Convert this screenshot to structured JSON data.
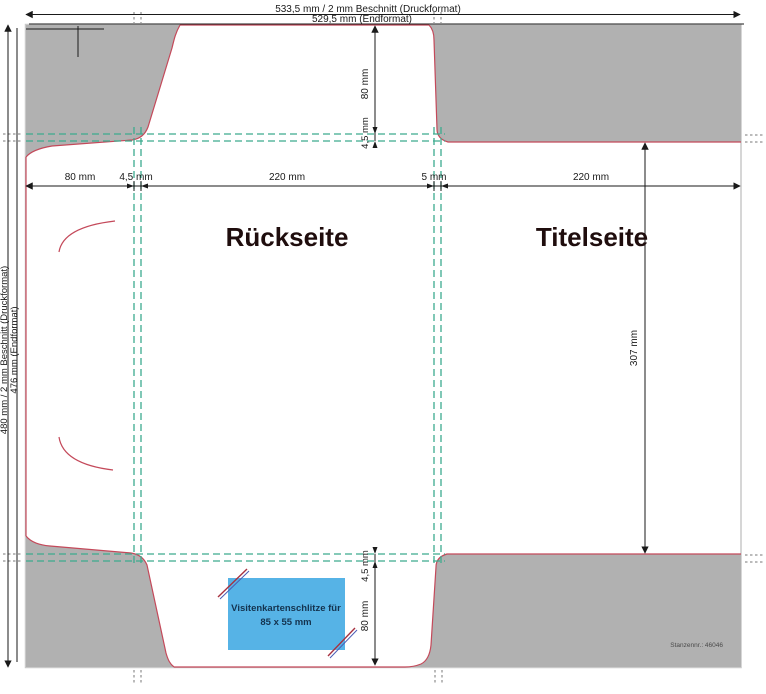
{
  "document": {
    "type": "die-cut folder template (Stanzform Präsentationsmappe)",
    "die_number": "Stanzennr.: 46046"
  },
  "dimensions": {
    "top_outer": "533,5 mm / 2 mm Beschnitt (Druckformat)",
    "top_inner": "529,5 mm (Endformat)",
    "left_outer": "480 mm / 2 mm Beschnitt (Druckformat)",
    "left_inner": "476 mm (Endformat)",
    "width_row": [
      "80 mm",
      "4,5 mm",
      "220 mm",
      "5 mm",
      "220 mm"
    ],
    "panel_height": "307 mm",
    "top_flap_height": "80 mm",
    "top_flap_crease": "4,5 mm",
    "bottom_flap_crease": "4,5 mm",
    "bottom_flap_height": "80 mm"
  },
  "panels": {
    "back_label": "Rückseite",
    "front_label": "Titelseite"
  },
  "business_card_slots": {
    "label_line1": "Visitenkartenschlitze für",
    "label_line2": "85 x 55 mm"
  },
  "colors": {
    "waste_gray": "#b1b1b1",
    "cut_line_red": "#c4495a",
    "fold_line_teal": "#3cab8e",
    "slot_box_blue": "#56b3e6",
    "dimension_black": "#1a1a1a"
  }
}
